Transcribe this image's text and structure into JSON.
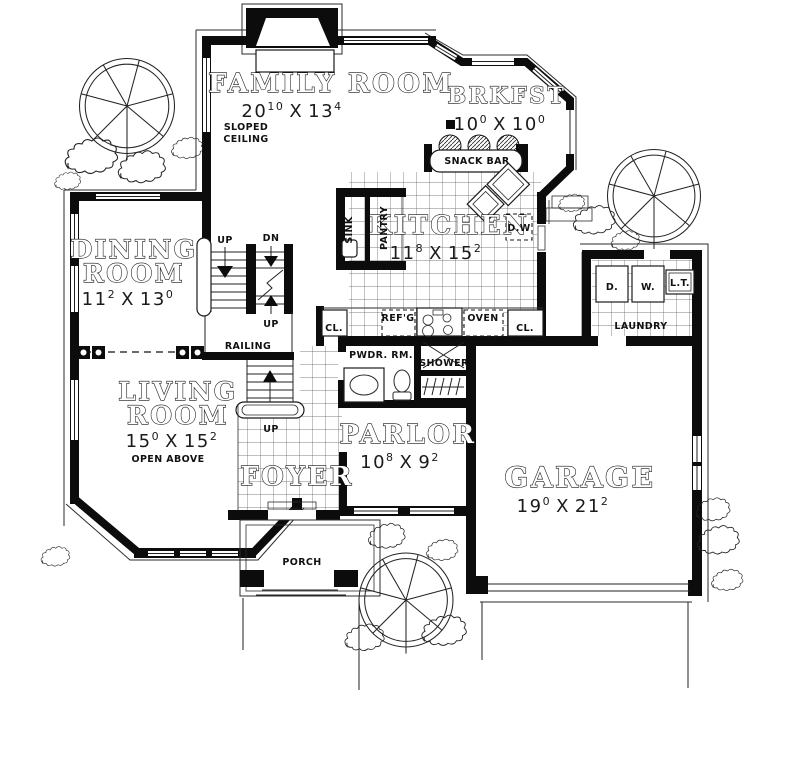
{
  "rooms": {
    "family_room": {
      "name": "FAMILY ROOM",
      "w": "20",
      "w_sup": "10",
      "sep": "X",
      "h": "13",
      "h_sup": "4",
      "note_line1": "SLOPED",
      "note_line2": "CEILING"
    },
    "breakfast": {
      "name": "BRKFST",
      "w": "10",
      "w_sup": "0",
      "sep": "X",
      "h": "10",
      "h_sup": "0"
    },
    "kitchen": {
      "name": "KITCHEN",
      "w": "11",
      "w_sup": "8",
      "sep": "X",
      "h": "15",
      "h_sup": "2"
    },
    "dining_room": {
      "name_line1": "DINING",
      "name_line2": "ROOM",
      "w": "11",
      "w_sup": "2",
      "sep": "X",
      "h": "13",
      "h_sup": "0"
    },
    "living_room": {
      "name_line1": "LIVING",
      "name_line2": "ROOM",
      "w": "15",
      "w_sup": "0",
      "sep": "X",
      "h": "15",
      "h_sup": "2",
      "note": "OPEN ABOVE"
    },
    "parlor": {
      "name": "PARLOR",
      "w": "10",
      "w_sup": "8",
      "sep": "X",
      "h": "9",
      "h_sup": "2"
    },
    "foyer": {
      "name": "FOYER"
    },
    "garage": {
      "name": "GARAGE",
      "w": "19",
      "w_sup": "0",
      "sep": "X",
      "h": "21",
      "h_sup": "2"
    },
    "laundry": {
      "name": "LAUNDRY"
    },
    "porch": {
      "name": "PORCH"
    }
  },
  "labels": {
    "snack_bar": "SNACK BAR",
    "sink": "SINK",
    "pantry": "PANTRY",
    "dishwasher": "D.W",
    "refrigerator": "REF'G",
    "oven": "OVEN",
    "closet_left": "CL.",
    "closet_right": "CL.",
    "powder_room": "PWDR. RM.",
    "shower": "SHOWER",
    "railing": "RAILING",
    "up_main": "UP",
    "down_main": "DN",
    "up_mid": "UP",
    "up_lower": "UP",
    "dryer": "D.",
    "washer": "W.",
    "laundry_tub": "L.T."
  },
  "colors": {
    "ink": "#0c0c0c",
    "paper": "#ffffff"
  }
}
